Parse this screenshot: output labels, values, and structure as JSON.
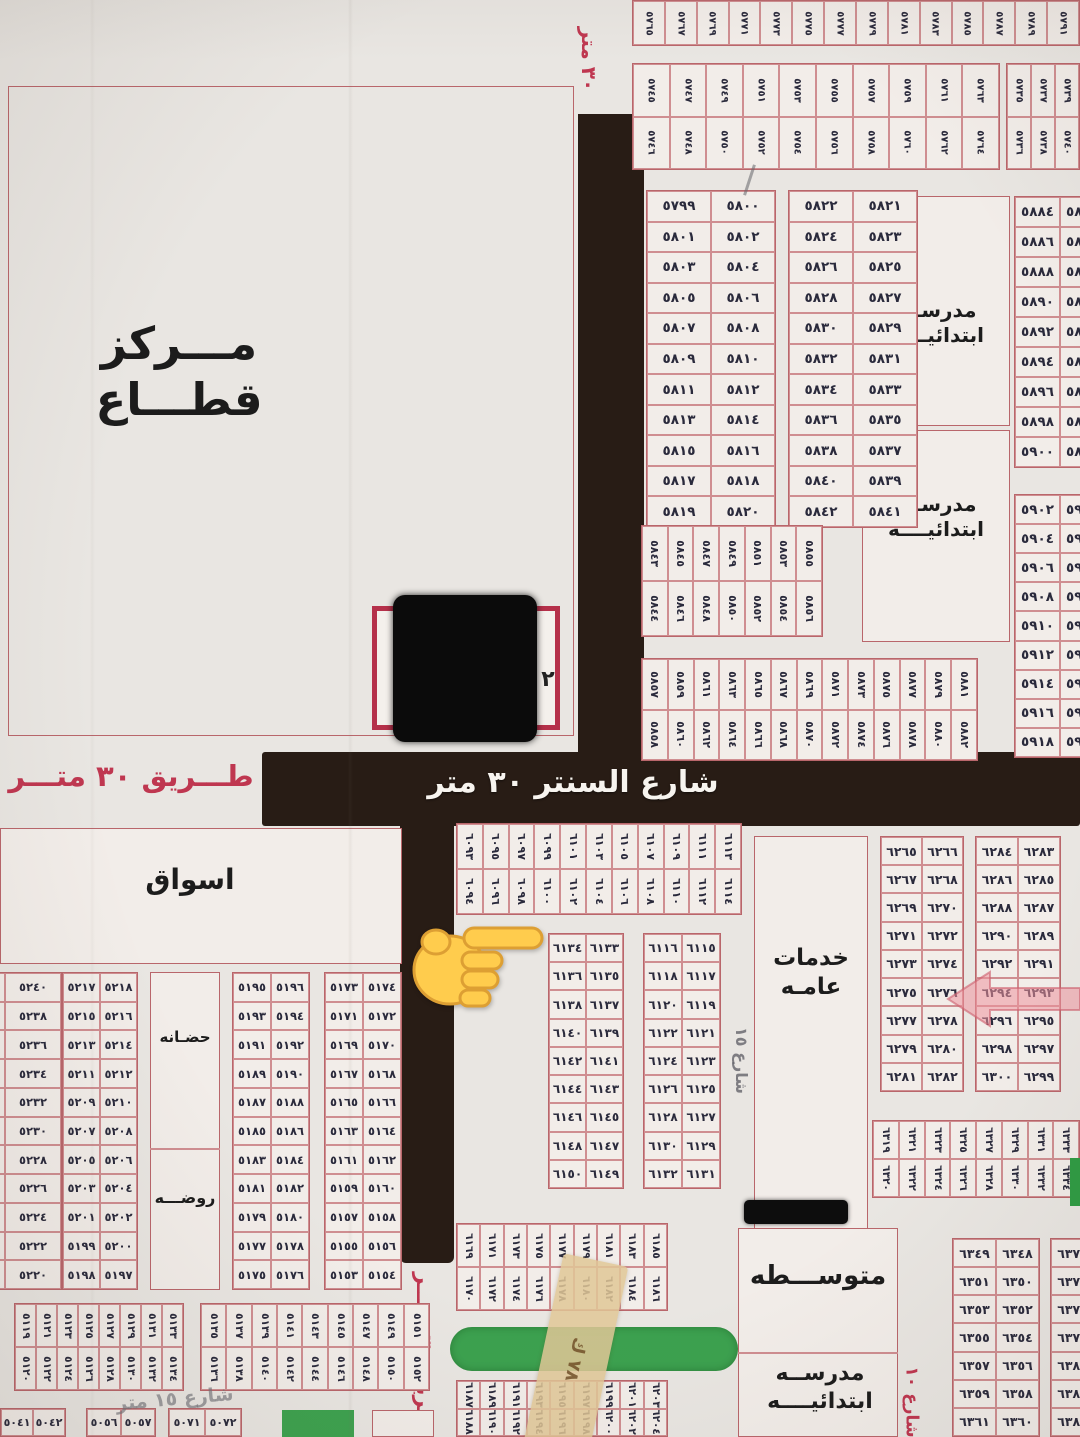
{
  "colors": {
    "paper": "#e9e6e2",
    "paper2": "#f2ede9",
    "road": "#281c15",
    "grid": "#cf8e91",
    "gridDark": "#b9666b",
    "ink": "#2a2a3c",
    "label": "#1c1c1c",
    "red": "#bf3750",
    "green": "#2f9c44",
    "pink": "#ef9aa6",
    "tape": "#dec394"
  },
  "labels": {
    "center_title": "مـــركز قطـــاع",
    "road_center": "شارع السنتر ٣٠ متر",
    "road_30": "طـــريق ٣٠ متـــر",
    "road_30_short": "٣٠ متر",
    "souq": "اسواق",
    "services_1": "خدمات",
    "services_2": "عامـه",
    "school_1": "مدرســه",
    "school_2": "ابتدائيــــه",
    "nursery": "حضـانه",
    "kindergarten": "روضـــه",
    "middle_school": "متوســـطه",
    "street15_hand": "شارع ١٥",
    "street10_hand": "شارع ١٠",
    "street15_pencil": "شارع ١٥ متر",
    "tape_text": "٧٨ ك",
    "box_mark": "٢"
  },
  "plots": {
    "digit_style": "arabic-indic",
    "blocks": [
      {
        "id": "top-row-cut",
        "kind": "vrow",
        "start": 5765,
        "step": 2,
        "count": 14,
        "pos": [
          632,
          0,
          448,
          46
        ],
        "fs": 10
      },
      {
        "id": "top-band",
        "kind": "vpairs",
        "start": 5745,
        "count": 10,
        "pos": [
          632,
          63,
          368,
          107
        ],
        "fs": 10
      },
      {
        "id": "top-band-right",
        "kind": "vpairs",
        "start": 5735,
        "count": 3,
        "pos": [
          1006,
          63,
          74,
          107
        ],
        "fs": 10
      },
      {
        "id": "a",
        "kind": "hpairs",
        "mode": "asc-lr",
        "start": 5799,
        "count": 11,
        "pos": [
          646,
          190,
          130,
          338
        ]
      },
      {
        "id": "b",
        "kind": "hpairs",
        "mode": "asc-rl",
        "start": 5821,
        "count": 11,
        "pos": [
          788,
          190,
          130,
          338
        ]
      },
      {
        "id": "c",
        "kind": "hpairs",
        "mode": "asc-rl",
        "start": 5883,
        "count": 9,
        "pos": [
          1014,
          196,
          92,
          272
        ]
      },
      {
        "id": "d2",
        "kind": "hpairs",
        "mode": "asc-rl",
        "start": 5901,
        "count": 9,
        "pos": [
          1014,
          494,
          92,
          264
        ]
      },
      {
        "id": "e",
        "kind": "vpairs",
        "start": 5843,
        "count": 7,
        "pos": [
          641,
          525,
          182,
          112
        ],
        "fs": 11
      },
      {
        "id": "f",
        "kind": "vpairs",
        "start": 5857,
        "count": 13,
        "pos": [
          641,
          658,
          337,
          103
        ],
        "fs": 11
      },
      {
        "id": "g",
        "kind": "vpairs",
        "start": 6093,
        "count": 11,
        "pos": [
          456,
          823,
          286,
          92
        ],
        "fs": 11
      },
      {
        "id": "h",
        "kind": "hpairs",
        "mode": "asc-rl",
        "start": 6133,
        "count": 9,
        "pos": [
          548,
          933,
          76,
          256
        ],
        "fs": 12
      },
      {
        "id": "i",
        "kind": "hpairs",
        "mode": "asc-rl",
        "start": 6115,
        "count": 9,
        "pos": [
          643,
          933,
          78,
          256
        ],
        "fs": 12
      },
      {
        "id": "j",
        "kind": "hpairs",
        "mode": "asc-lr",
        "start": 6265,
        "count": 9,
        "pos": [
          880,
          836,
          84,
          256
        ],
        "fs": 12.5
      },
      {
        "id": "k",
        "kind": "hpairs",
        "mode": "asc-rl",
        "start": 6283,
        "count": 9,
        "pos": [
          975,
          836,
          86,
          256
        ],
        "fs": 12.5
      },
      {
        "id": "l",
        "kind": "hpairs",
        "mode": "desc-lr",
        "start": 5239,
        "count": 11,
        "pos": [
          -52,
          972,
          114,
          318
        ],
        "fs": 11.5
      },
      {
        "id": "m",
        "kind": "hpairs",
        "mode": "desc-lr",
        "start": 5217,
        "count": 10,
        "extra": [
          [
            5198,
            5197
          ]
        ],
        "pos": [
          62,
          972,
          76,
          318
        ],
        "fs": 11.5
      },
      {
        "id": "n",
        "kind": "hpairs",
        "mode": "desc-lr",
        "start": 5195,
        "count": 11,
        "pos": [
          232,
          972,
          78,
          318
        ],
        "fs": 11.5
      },
      {
        "id": "o",
        "kind": "hpairs",
        "mode": "desc-lr",
        "start": 5173,
        "count": 11,
        "pos": [
          324,
          972,
          78,
          318
        ],
        "fs": 11.5
      },
      {
        "id": "p",
        "kind": "vpairs",
        "start": 6169,
        "count": 9,
        "pos": [
          456,
          1223,
          212,
          88
        ],
        "fs": 10.5
      },
      {
        "id": "q",
        "kind": "vpairs",
        "start": 6187,
        "count": 9,
        "pos": [
          456,
          1380,
          212,
          57
        ],
        "fs": 10.5
      },
      {
        "id": "r1",
        "kind": "vpairs",
        "start": 5119,
        "count": 8,
        "pos": [
          14,
          1303,
          170,
          88
        ],
        "fs": 10.5
      },
      {
        "id": "r2",
        "kind": "vpairs",
        "start": 5135,
        "count": 9,
        "pos": [
          200,
          1303,
          230,
          88
        ],
        "fs": 10.5
      },
      {
        "id": "s",
        "kind": "hpairs",
        "mode": "asc-rl",
        "start": 6348,
        "count": 7,
        "pos": [
          952,
          1238,
          88,
          199
        ],
        "fs": 12.5
      },
      {
        "id": "t",
        "kind": "hpairs",
        "mode": "asc-rl",
        "start": 6372,
        "count": 7,
        "pos": [
          1050,
          1238,
          88,
          199
        ],
        "fs": 12.5
      },
      {
        "id": "u",
        "kind": "vpairs",
        "start": 6319,
        "count": 8,
        "pos": [
          872,
          1120,
          208,
          78
        ],
        "fs": 10.5
      },
      {
        "id": "br1",
        "kind": "rows",
        "values": [
          [
            5041,
            5042
          ]
        ],
        "pos": [
          0,
          1408,
          66,
          29
        ],
        "fs": 11
      },
      {
        "id": "br2",
        "kind": "rows",
        "values": [
          [
            5056,
            5057
          ]
        ],
        "pos": [
          86,
          1408,
          70,
          29
        ],
        "fs": 11
      },
      {
        "id": "br3",
        "kind": "rows",
        "values": [
          [
            5071,
            5072
          ]
        ],
        "pos": [
          168,
          1408,
          74,
          29
        ],
        "fs": 11
      }
    ]
  }
}
